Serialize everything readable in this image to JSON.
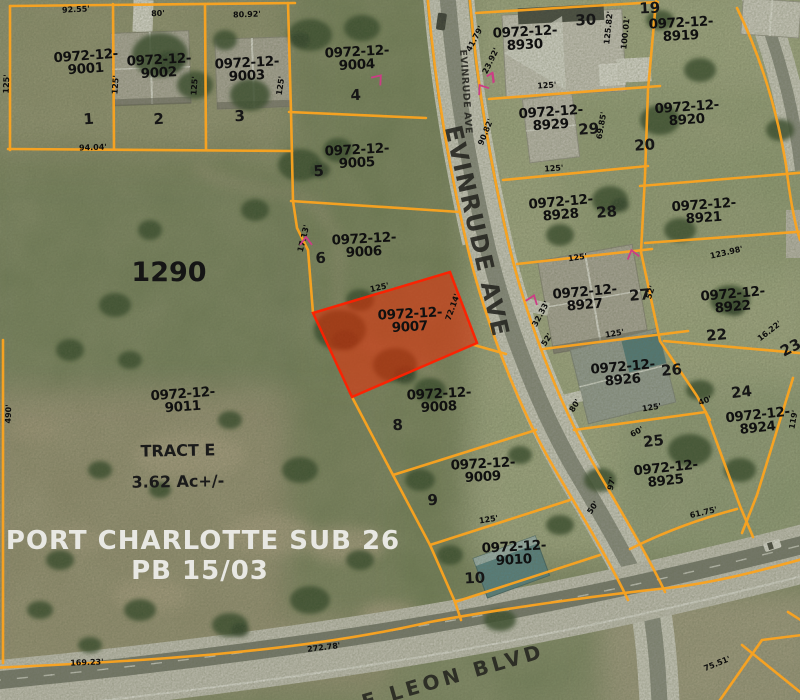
{
  "map": {
    "colors": {
      "parcel_line": "#fca41f",
      "highlight_fill": "#f02800",
      "highlight_stroke": "#ff2000",
      "label_text": "#101010",
      "subdivision_text": "#e8e8e3",
      "survey_mark": "#cc3d85"
    },
    "subdivision": {
      "name": "PORT CHARLOTTE SUB 26",
      "plat_book": "PB 15/03",
      "tract": "TRACT E",
      "acreage": "3.62 Ac+/-",
      "block": "1290"
    },
    "highlighted_parcel_id": "0972-12-9007",
    "streets": [
      {
        "name": "EVINRUDE AVE",
        "x": 463,
        "y": 92,
        "rot": 86,
        "size": 9.5,
        "spacing": 0.5
      },
      {
        "name": "EVINRUDE AVE",
        "x": 469,
        "y": 233,
        "rot": 77,
        "size": 24,
        "spacing": 1.5
      },
      {
        "name": "E LEON BLVD",
        "x": 455,
        "y": 683,
        "rot": -16,
        "size": 20,
        "spacing": 4
      }
    ],
    "parcels": [
      {
        "id": "0972-12-9001",
        "line1": "0972-12-",
        "line2": "9001",
        "x": 86,
        "y": 66,
        "rot": -4,
        "lot": "1",
        "lot_x": 89,
        "lot_y": 124
      },
      {
        "id": "0972-12-9002",
        "line1": "0972-12-",
        "line2": "9002",
        "x": 159,
        "y": 70,
        "rot": -3,
        "lot": "2",
        "lot_x": 159,
        "lot_y": 124
      },
      {
        "id": "0972-12-9003",
        "line1": "0972-12-",
        "line2": "9003",
        "x": 247,
        "y": 73,
        "rot": -3,
        "lot": "3",
        "lot_x": 240,
        "lot_y": 121
      },
      {
        "id": "0972-12-9004",
        "line1": "0972-12-",
        "line2": "9004",
        "x": 357,
        "y": 62,
        "rot": -3,
        "lot": "4",
        "lot_x": 356,
        "lot_y": 100
      },
      {
        "id": "0972-12-9005",
        "line1": "0972-12-",
        "line2": "9005",
        "x": 357,
        "y": 160,
        "rot": -3,
        "lot": "5",
        "lot_x": 319,
        "lot_y": 176
      },
      {
        "id": "0972-12-9006",
        "line1": "0972-12-",
        "line2": "9006",
        "x": 364,
        "y": 249,
        "rot": -3,
        "lot": "6",
        "lot_x": 321,
        "lot_y": 263
      },
      {
        "id": "0972-12-9007",
        "line1": "0972-12-",
        "line2": "9007",
        "x": 410,
        "y": 324,
        "rot": -3,
        "lot": "",
        "highlighted": true
      },
      {
        "id": "0972-12-9008",
        "line1": "0972-12-",
        "line2": "9008",
        "x": 439,
        "y": 404,
        "rot": -3,
        "lot": "8",
        "lot_x": 398,
        "lot_y": 430
      },
      {
        "id": "0972-12-9009",
        "line1": "0972-12-",
        "line2": "9009",
        "x": 483,
        "y": 474,
        "rot": -3,
        "lot": "9",
        "lot_x": 433,
        "lot_y": 505
      },
      {
        "id": "0972-12-9010",
        "line1": "0972-12-",
        "line2": "9010",
        "x": 514,
        "y": 557,
        "rot": -3,
        "lot": "10",
        "lot_x": 475,
        "lot_y": 583
      },
      {
        "id": "0972-12-9011",
        "line1": "0972-12-",
        "line2": "9011",
        "x": 183,
        "y": 404,
        "rot": -4,
        "lot": ""
      },
      {
        "id": "0972-12-8930",
        "line1": "0972-12-",
        "line2": "8930",
        "x": 525,
        "y": 42,
        "rot": -3,
        "lot": "30",
        "lot_x": 586,
        "lot_y": 25
      },
      {
        "id": "0972-12-8919",
        "line1": "0972-12-",
        "line2": "8919",
        "x": 681,
        "y": 33,
        "rot": -3,
        "lot": "19",
        "lot_x": 650,
        "lot_y": 13
      },
      {
        "id": "0972-12-8929",
        "line1": "0972-12-",
        "line2": "8929",
        "x": 551,
        "y": 122,
        "rot": -4,
        "lot": "29",
        "lot_x": 589,
        "lot_y": 134
      },
      {
        "id": "0972-12-8920",
        "line1": "0972-12-",
        "line2": "8920",
        "x": 687,
        "y": 117,
        "rot": -4,
        "lot": "20",
        "lot_x": 645,
        "lot_y": 150
      },
      {
        "id": "0972-12-8928",
        "line1": "0972-12-",
        "line2": "8928",
        "x": 561,
        "y": 212,
        "rot": -5,
        "lot": "28",
        "lot_x": 607,
        "lot_y": 217
      },
      {
        "id": "0972-12-8921",
        "line1": "0972-12-",
        "line2": "8921",
        "x": 704,
        "y": 215,
        "rot": -4,
        "lot": ""
      },
      {
        "id": "0972-12-8927",
        "line1": "0972-12-",
        "line2": "8927",
        "x": 585,
        "y": 302,
        "rot": -5,
        "lot": "27",
        "lot_x": 640,
        "lot_y": 300
      },
      {
        "id": "0972-12-8922",
        "line1": "0972-12-",
        "line2": "8922",
        "x": 733,
        "y": 304,
        "rot": -5,
        "lot": "22",
        "lot_x": 717,
        "lot_y": 340
      },
      {
        "id": "0972-12-8926",
        "line1": "0972-12-",
        "line2": "8926",
        "x": 623,
        "y": 377,
        "rot": -5,
        "lot": "26",
        "lot_x": 672,
        "lot_y": 375
      },
      {
        "id": "0972-12-8924",
        "line1": "0972-12-",
        "line2": "8924",
        "x": 758,
        "y": 425,
        "rot": -6,
        "lot": "24",
        "lot_x": 742,
        "lot_y": 397
      },
      {
        "id": "0972-12-8925",
        "line1": "0972-12-",
        "line2": "8925",
        "x": 666,
        "y": 478,
        "rot": -6,
        "lot": "25",
        "lot_x": 654,
        "lot_y": 446
      }
    ],
    "extra_lots": [
      {
        "lot": "23",
        "x": 793,
        "y": 352,
        "rot": -28
      }
    ],
    "annotations": [
      {
        "text": "1290",
        "x": 169,
        "y": 281,
        "size": 27,
        "color": "#151515",
        "rot": 0
      },
      {
        "text": "TRACT E",
        "x": 178,
        "y": 456,
        "size": 16,
        "color": "#1a1a1a",
        "rot": -1
      },
      {
        "text": "3.62 Ac+/-",
        "x": 178,
        "y": 487,
        "size": 16,
        "color": "#1a1a1a",
        "rot": -1
      },
      {
        "text": "PORT CHARLOTTE SUB 26",
        "x": 203,
        "y": 549,
        "size": 26,
        "color": "#e8e8e3",
        "rot": 0,
        "spacing": 1
      },
      {
        "text": "PB 15/03",
        "x": 200,
        "y": 579,
        "size": 26,
        "color": "#e8e8e3",
        "rot": 0,
        "spacing": 1
      },
      {
        "text": "7",
        "x": 495,
        "y": 82,
        "size": 14,
        "color": "#cc3d85",
        "rot": -32
      }
    ],
    "dimensions": [
      {
        "t": "92.55'",
        "x": 76,
        "y": 12,
        "r": -3
      },
      {
        "t": "80'",
        "x": 158,
        "y": 16,
        "r": -2
      },
      {
        "t": "80.92'",
        "x": 247,
        "y": 17,
        "r": -2
      },
      {
        "t": "125'",
        "x": 9,
        "y": 84,
        "r": -88
      },
      {
        "t": "125'",
        "x": 118,
        "y": 85,
        "r": -86
      },
      {
        "t": "125'",
        "x": 197,
        "y": 86,
        "r": -86
      },
      {
        "t": "125'",
        "x": 283,
        "y": 86,
        "r": -82
      },
      {
        "t": "94.04'",
        "x": 93,
        "y": 150,
        "r": -2
      },
      {
        "t": "17.13'",
        "x": 306,
        "y": 239,
        "r": -76
      },
      {
        "t": "41.79'",
        "x": 477,
        "y": 40,
        "r": -62
      },
      {
        "t": "23.92'",
        "x": 493,
        "y": 62,
        "r": -64
      },
      {
        "t": "125.82'",
        "x": 611,
        "y": 28,
        "r": -84
      },
      {
        "t": "100.01'",
        "x": 628,
        "y": 33,
        "r": -84
      },
      {
        "t": "125'",
        "x": 547,
        "y": 88,
        "r": -4
      },
      {
        "t": "90.82'",
        "x": 488,
        "y": 133,
        "r": -68
      },
      {
        "t": "69.85'",
        "x": 604,
        "y": 126,
        "r": -80
      },
      {
        "t": "125'",
        "x": 554,
        "y": 171,
        "r": -4
      },
      {
        "t": "125'",
        "x": 578,
        "y": 260,
        "r": -8
      },
      {
        "t": "123.98'",
        "x": 727,
        "y": 255,
        "r": -13
      },
      {
        "t": "32.33'",
        "x": 543,
        "y": 315,
        "r": -62
      },
      {
        "t": "52'",
        "x": 549,
        "y": 341,
        "r": -58
      },
      {
        "t": "52'",
        "x": 653,
        "y": 293,
        "r": -72
      },
      {
        "t": "125'",
        "x": 615,
        "y": 336,
        "r": -10
      },
      {
        "t": "16.22'",
        "x": 771,
        "y": 333,
        "r": -38
      },
      {
        "t": "125'",
        "x": 380,
        "y": 290,
        "r": -13
      },
      {
        "t": "72.14'",
        "x": 455,
        "y": 308,
        "r": -70
      },
      {
        "t": "80'",
        "x": 577,
        "y": 407,
        "r": -58
      },
      {
        "t": "125'",
        "x": 652,
        "y": 410,
        "r": -9
      },
      {
        "t": "60'",
        "x": 638,
        "y": 434,
        "r": -28
      },
      {
        "t": "40'",
        "x": 706,
        "y": 403,
        "r": -22
      },
      {
        "t": "97'",
        "x": 614,
        "y": 484,
        "r": -78
      },
      {
        "t": "50'",
        "x": 595,
        "y": 509,
        "r": -55
      },
      {
        "t": "61.75'",
        "x": 704,
        "y": 515,
        "r": -13
      },
      {
        "t": "119'",
        "x": 796,
        "y": 420,
        "r": -80
      },
      {
        "t": "125'",
        "x": 489,
        "y": 522,
        "r": -9
      },
      {
        "t": "169.23'",
        "x": 87,
        "y": 665,
        "r": -2
      },
      {
        "t": "272.78'",
        "x": 324,
        "y": 650,
        "r": -7
      },
      {
        "t": "75.51'",
        "x": 718,
        "y": 666,
        "r": -22
      },
      {
        "t": "490'",
        "x": 11,
        "y": 414,
        "r": -88
      }
    ],
    "survey_marks": [
      {
        "x": 377,
        "y": 80,
        "rot": 40
      },
      {
        "x": 306,
        "y": 243,
        "rot": 0
      },
      {
        "x": 633,
        "y": 256,
        "rot": -15
      },
      {
        "x": 532,
        "y": 301,
        "rot": 20
      },
      {
        "x": 483,
        "y": 90,
        "rot": -35
      }
    ]
  }
}
